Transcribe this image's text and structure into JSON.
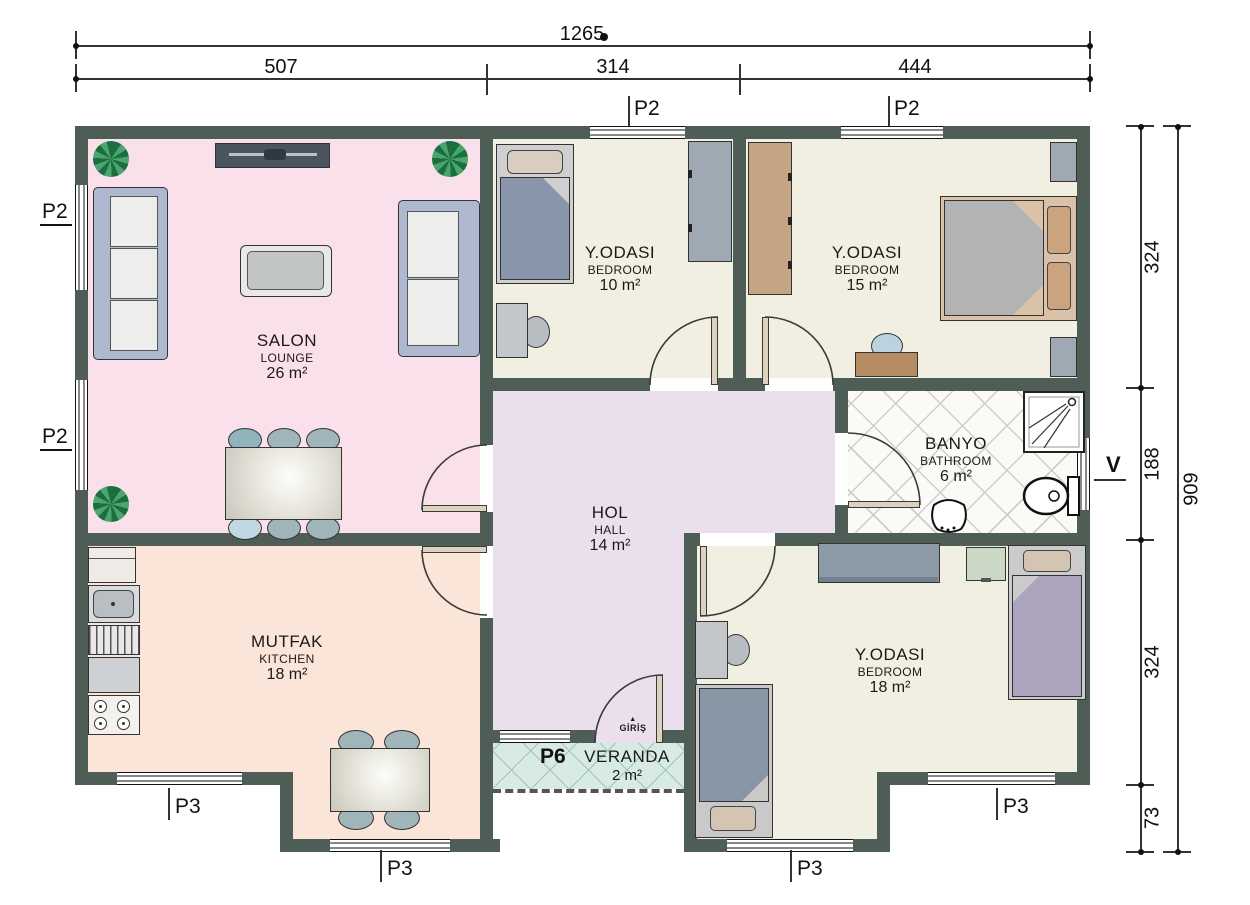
{
  "labels": {
    "p2": "P2",
    "p3": "P3",
    "p6": "P6",
    "v": "V"
  },
  "entrance": {
    "label": "GİRİŞ"
  },
  "rooms": {
    "salon": {
      "name": "SALON",
      "type": "LOUNGE",
      "area": "26 m²"
    },
    "bedroom_small": {
      "name": "Y.ODASI",
      "type": "BEDROOM",
      "area": "10 m²"
    },
    "bedroom_master": {
      "name": "Y.ODASI",
      "type": "BEDROOM",
      "area": "15 m²"
    },
    "bathroom": {
      "name": "BANYO",
      "type": "BATHROOM",
      "area": "6 m²"
    },
    "hall": {
      "name": "HOL",
      "type": "HALL",
      "area": "14 m²"
    },
    "kitchen": {
      "name": "MUTFAK",
      "type": "KITCHEN",
      "area": "18 m²"
    },
    "bedroom_bottom": {
      "name": "Y.ODASI",
      "type": "BEDROOM",
      "area": "18 m²"
    },
    "veranda": {
      "name": "VERANDA",
      "area": "2 m²"
    }
  },
  "dims": {
    "top": {
      "total": "1265",
      "segments": [
        "507",
        "314",
        "444"
      ]
    },
    "right": {
      "total": "909",
      "segments": [
        "324",
        "188",
        "324",
        "73"
      ]
    }
  },
  "colors": {
    "wall": "#4F5D57",
    "salon_floor": "#F9E0EA",
    "kitchen_floor": "#FBE5D8",
    "bedroom_floor": "#F0EFE1",
    "hall_floor": "#EBDFED",
    "bathroom_floor": "#FBFAF7",
    "veranda_floor": "#D8EBE3",
    "sofa": "#AEB9D0",
    "wood": "#C5A484",
    "blanket_blue": "#8895AB",
    "blanket_purple": "#ACA5BD",
    "plant": "#1C6E40"
  }
}
